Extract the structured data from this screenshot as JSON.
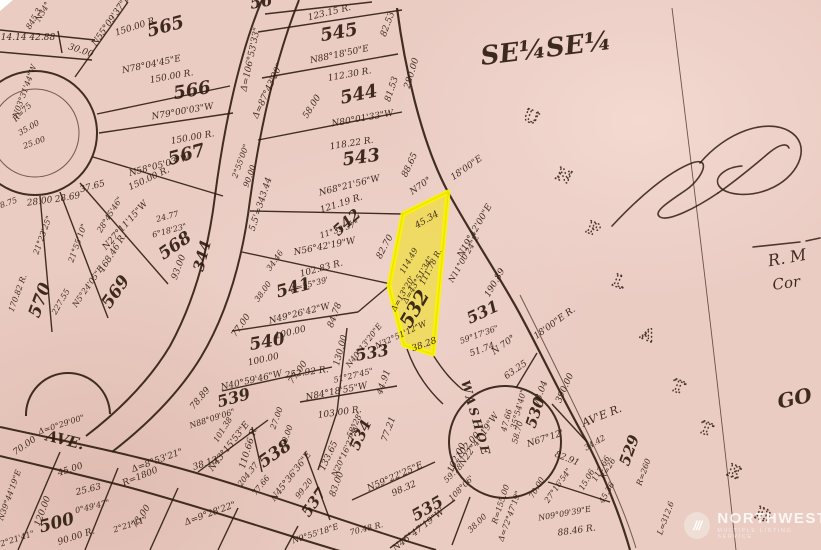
{
  "map": {
    "paper_color": "#eaccc3",
    "ink_color": "#2f1c10",
    "section_label": "SE¼SE¼",
    "highlight_lot": {
      "number": "532",
      "fill": "#f2e300",
      "stroke": "#fcf400"
    },
    "unplatted": {
      "letters": [
        "U",
        "N",
        "P",
        "L",
        "A",
        "T",
        "T",
        "E",
        "D"
      ],
      "positions": [
        [
          529,
          122
        ],
        [
          562,
          181
        ],
        [
          591,
          234
        ],
        [
          617,
          287
        ],
        [
          646,
          340
        ],
        [
          676,
          392
        ],
        [
          704,
          434
        ],
        [
          732,
          477
        ],
        [
          761,
          520
        ]
      ]
    },
    "labels": [
      {
        "t": "565",
        "x": 167,
        "y": 32,
        "r": -15,
        "s": 18,
        "b": 1
      },
      {
        "t": "566",
        "x": 193,
        "y": 96,
        "r": -10,
        "s": 18,
        "b": 1
      },
      {
        "t": "567",
        "x": 188,
        "y": 160,
        "r": -15,
        "s": 18,
        "b": 1
      },
      {
        "t": "568",
        "x": 178,
        "y": 250,
        "r": -35,
        "s": 17,
        "b": 1
      },
      {
        "t": "569",
        "x": 120,
        "y": 295,
        "r": -55,
        "s": 17,
        "b": 1
      },
      {
        "t": "570",
        "x": 45,
        "y": 302,
        "r": -70,
        "s": 17,
        "b": 1
      },
      {
        "t": "56",
        "x": 262,
        "y": 7,
        "r": -10,
        "s": 16,
        "b": 1
      },
      {
        "t": "545",
        "x": 340,
        "y": 38,
        "r": -10,
        "s": 18,
        "b": 1
      },
      {
        "t": "544",
        "x": 360,
        "y": 100,
        "r": -12,
        "s": 18,
        "b": 1
      },
      {
        "t": "543",
        "x": 362,
        "y": 163,
        "r": -8,
        "s": 18,
        "b": 1
      },
      {
        "t": "542",
        "x": 350,
        "y": 226,
        "r": -42,
        "s": 15,
        "b": 1
      },
      {
        "t": "541",
        "x": 295,
        "y": 293,
        "r": -15,
        "s": 17,
        "b": 1
      },
      {
        "t": "540",
        "x": 268,
        "y": 347,
        "r": -10,
        "s": 17,
        "b": 1
      },
      {
        "t": "539",
        "x": 235,
        "y": 403,
        "r": -15,
        "s": 16,
        "b": 1
      },
      {
        "t": "538",
        "x": 278,
        "y": 458,
        "r": -35,
        "s": 17,
        "b": 1
      },
      {
        "t": "537",
        "x": 318,
        "y": 505,
        "r": -55,
        "s": 15,
        "b": 1
      },
      {
        "t": "535",
        "x": 430,
        "y": 513,
        "r": -30,
        "s": 16,
        "b": 1
      },
      {
        "t": "534",
        "x": 365,
        "y": 437,
        "r": -65,
        "s": 15,
        "b": 1
      },
      {
        "t": "533",
        "x": 373,
        "y": 358,
        "r": -10,
        "s": 16,
        "b": 1
      },
      {
        "t": "532",
        "x": 420,
        "y": 312,
        "r": -60,
        "s": 19,
        "b": 1
      },
      {
        "t": "531",
        "x": 485,
        "y": 317,
        "r": -25,
        "s": 16,
        "b": 1
      },
      {
        "t": "530",
        "x": 540,
        "y": 414,
        "r": -72,
        "s": 15,
        "b": 1
      },
      {
        "t": "529",
        "x": 634,
        "y": 452,
        "r": -70,
        "s": 15,
        "b": 1
      },
      {
        "t": "500",
        "x": 58,
        "y": 528,
        "r": -15,
        "s": 17,
        "b": 1
      },
      {
        "t": "344",
        "x": 207,
        "y": 257,
        "r": -75,
        "s": 15,
        "b": 1
      },
      {
        "t": "WASHOE",
        "x": 472,
        "y": 420,
        "r": 74,
        "s": 12,
        "b": 1,
        "ls": 3
      },
      {
        "t": "AVE.",
        "x": 64,
        "y": 445,
        "r": 14,
        "s": 15,
        "b": 1
      },
      {
        "t": "AV'E R.",
        "x": 603,
        "y": 419,
        "r": -22,
        "s": 11
      },
      {
        "t": "SE¼SE¼",
        "x": 547,
        "y": 57,
        "r": -7,
        "s": 26,
        "b": 1
      },
      {
        "t": "GO",
        "x": 796,
        "y": 405,
        "r": -12,
        "s": 20,
        "b": 1
      },
      {
        "t": "R. M",
        "x": 788,
        "y": 263,
        "r": -10,
        "s": 16
      },
      {
        "t": "Cor",
        "x": 787,
        "y": 288,
        "r": -8,
        "s": 15
      },
      {
        "t": "14.14 42.88",
        "x": 28,
        "y": 40,
        "r": 0
      },
      {
        "t": "30.00",
        "x": 80,
        "y": 53,
        "r": 18
      },
      {
        "t": "N55°09'37\"E",
        "x": 113,
        "y": 22,
        "r": -55
      },
      {
        "t": "150.00 R.",
        "x": 137,
        "y": 29,
        "r": -18
      },
      {
        "t": "N78°04'45\"E",
        "x": 152,
        "y": 67,
        "r": -12
      },
      {
        "t": "150.00 R.",
        "x": 172,
        "y": 79,
        "r": -10
      },
      {
        "t": "N79°00'03\"W",
        "x": 183,
        "y": 114,
        "r": -10
      },
      {
        "t": "150.00 R.",
        "x": 193,
        "y": 140,
        "r": -10
      },
      {
        "t": "N58°05'03\"W",
        "x": 160,
        "y": 168,
        "r": -15
      },
      {
        "t": "N34°",
        "x": 45,
        "y": 13,
        "r": -60,
        "s": 8
      },
      {
        "t": "845.3",
        "x": 36,
        "y": 20,
        "r": -60,
        "s": 8
      },
      {
        "t": "2°55'00\"",
        "x": 243,
        "y": 162,
        "r": -70,
        "s": 8
      },
      {
        "t": "90.00",
        "x": 252,
        "y": 177,
        "r": -70,
        "s": 8
      },
      {
        "t": "Δ=87°43'20\"",
        "x": 270,
        "y": 92,
        "r": -65
      },
      {
        "t": "Δ=106°53'33\"",
        "x": 253,
        "y": 60,
        "r": -78
      },
      {
        "t": "5.5'=343.44",
        "x": 263,
        "y": 205,
        "r": -72
      },
      {
        "t": "123.15 R.",
        "x": 330,
        "y": 15,
        "r": -14
      },
      {
        "t": "82.53",
        "x": 390,
        "y": 25,
        "r": -70
      },
      {
        "t": "N88°18'50\"E",
        "x": 340,
        "y": 57,
        "r": -12
      },
      {
        "t": "112.30 R.",
        "x": 350,
        "y": 77,
        "r": -10
      },
      {
        "t": "81.53",
        "x": 394,
        "y": 90,
        "r": -72
      },
      {
        "t": "58.00",
        "x": 314,
        "y": 108,
        "r": -58
      },
      {
        "t": "280.00",
        "x": 414,
        "y": 74,
        "r": -73
      },
      {
        "t": "N80°01'33\"W",
        "x": 363,
        "y": 121,
        "r": -10
      },
      {
        "t": "118.22 R.",
        "x": 352,
        "y": 146,
        "r": -9
      },
      {
        "t": "88.65",
        "x": 412,
        "y": 166,
        "r": -65
      },
      {
        "t": "N68°21'56\"W",
        "x": 350,
        "y": 188,
        "r": -14
      },
      {
        "t": "N70°",
        "x": 422,
        "y": 188,
        "r": -35
      },
      {
        "t": "18'00\"E",
        "x": 468,
        "y": 170,
        "r": -35
      },
      {
        "t": "121.19 R.",
        "x": 342,
        "y": 206,
        "r": -18
      },
      {
        "t": "11°39'37\"",
        "x": 340,
        "y": 232,
        "r": -18,
        "s": 8
      },
      {
        "t": "82.70",
        "x": 387,
        "y": 248,
        "r": -62
      },
      {
        "t": "N56°42'19\"W",
        "x": 325,
        "y": 249,
        "r": -11
      },
      {
        "t": "102.83 R.",
        "x": 322,
        "y": 271,
        "r": -15
      },
      {
        "t": "Δ=55°39'",
        "x": 310,
        "y": 287,
        "r": -15,
        "s": 8
      },
      {
        "t": "34.46",
        "x": 277,
        "y": 262,
        "r": -55,
        "s": 8
      },
      {
        "t": "38.00",
        "x": 265,
        "y": 293,
        "r": -55,
        "s": 8
      },
      {
        "t": "84.78",
        "x": 337,
        "y": 316,
        "r": -70
      },
      {
        "t": "N49°26'42\"W",
        "x": 300,
        "y": 316,
        "r": -14
      },
      {
        "t": "100.00",
        "x": 291,
        "y": 335,
        "r": -14
      },
      {
        "t": "77.00",
        "x": 243,
        "y": 327,
        "r": -55
      },
      {
        "t": "100.00",
        "x": 264,
        "y": 362,
        "r": -13
      },
      {
        "t": "N40°59'46\"W",
        "x": 252,
        "y": 383,
        "r": -13
      },
      {
        "t": "77.00",
        "x": 300,
        "y": 374,
        "r": -55
      },
      {
        "t": "130.00",
        "x": 343,
        "y": 351,
        "r": -75
      },
      {
        "t": "N40°13'20\"E",
        "x": 366,
        "y": 347,
        "r": -52,
        "s": 8
      },
      {
        "t": "252.92 R.",
        "x": 307,
        "y": 375,
        "r": -8
      },
      {
        "t": "51°27'45\"",
        "x": 354,
        "y": 378,
        "r": -14,
        "s": 8
      },
      {
        "t": "N84°18'55\"W",
        "x": 337,
        "y": 394,
        "r": -11
      },
      {
        "t": "44.91",
        "x": 386,
        "y": 383,
        "r": -70
      },
      {
        "t": "103.00 R.",
        "x": 340,
        "y": 415,
        "r": -8
      },
      {
        "t": "45.34",
        "x": 428,
        "y": 222,
        "r": -30
      },
      {
        "t": "111.78 R.",
        "x": 433,
        "y": 268,
        "r": -63,
        "s": 8
      },
      {
        "t": "114.49",
        "x": 411,
        "y": 262,
        "r": -60,
        "s": 8
      },
      {
        "t": "Δ=43°51'34\"",
        "x": 420,
        "y": 281,
        "r": -60,
        "s": 8
      },
      {
        "t": "Δ=13°20'",
        "x": 405,
        "y": 295,
        "r": -60,
        "s": 8
      },
      {
        "t": "N32°51'12\"W",
        "x": 402,
        "y": 337,
        "r": -25,
        "s": 8
      },
      {
        "t": "38.28",
        "x": 425,
        "y": 347,
        "r": -20
      },
      {
        "t": "N19°42'00\"E",
        "x": 477,
        "y": 232,
        "r": -60
      },
      {
        "t": "N11°00'24\"E",
        "x": 466,
        "y": 260,
        "r": -60,
        "s": 8
      },
      {
        "t": "190.89",
        "x": 497,
        "y": 284,
        "r": -60
      },
      {
        "t": "59°17'36\"",
        "x": 480,
        "y": 337,
        "r": -20,
        "s": 8
      },
      {
        "t": "51.74",
        "x": 483,
        "y": 352,
        "r": -20
      },
      {
        "t": "N 70°",
        "x": 505,
        "y": 347,
        "r": -36
      },
      {
        "t": "18'00\"E R.",
        "x": 556,
        "y": 325,
        "r": -36
      },
      {
        "t": "63.25",
        "x": 517,
        "y": 372,
        "r": -35
      },
      {
        "t": "390.00",
        "x": 567,
        "y": 389,
        "r": -66
      },
      {
        "t": "78.04",
        "x": 543,
        "y": 394,
        "r": -70
      },
      {
        "t": "35°54'40\"",
        "x": 521,
        "y": 410,
        "r": -75,
        "s": 8
      },
      {
        "t": "47.66",
        "x": 509,
        "y": 421,
        "r": -75,
        "s": 8
      },
      {
        "t": "58.70",
        "x": 520,
        "y": 433,
        "r": -75,
        "s": 8
      },
      {
        "t": "N67°12'",
        "x": 546,
        "y": 441,
        "r": -18
      },
      {
        "t": "82.91",
        "x": 566,
        "y": 461,
        "r": 22
      },
      {
        "t": "70.00",
        "x": 539,
        "y": 489,
        "r": -60,
        "s": 8
      },
      {
        "t": "27°16'54\"",
        "x": 560,
        "y": 487,
        "r": -55,
        "s": 8
      },
      {
        "t": "N22°47'19\"W",
        "x": 481,
        "y": 441,
        "r": -55
      },
      {
        "t": "102.00",
        "x": 459,
        "y": 459,
        "r": -65
      },
      {
        "t": "R=155.00",
        "x": 503,
        "y": 505,
        "r": -72,
        "s": 8
      },
      {
        "t": "Δ=72°47'19\"",
        "x": 512,
        "y": 517,
        "r": -70,
        "s": 8
      },
      {
        "t": "34.42",
        "x": 596,
        "y": 445,
        "r": -30,
        "s": 8
      },
      {
        "t": "15.06",
        "x": 589,
        "y": 481,
        "r": -60,
        "s": 8
      },
      {
        "t": "R=26",
        "x": 610,
        "y": 470,
        "r": -60,
        "s": 8
      },
      {
        "t": "N09°09'39\"E",
        "x": 565,
        "y": 516,
        "r": -10,
        "s": 8
      },
      {
        "t": "88.46 R.",
        "x": 577,
        "y": 533,
        "r": -8
      },
      {
        "t": "R=260",
        "x": 646,
        "y": 473,
        "r": -70,
        "s": 8
      },
      {
        "t": "L=312.6",
        "x": 668,
        "y": 519,
        "r": -70,
        "s": 8
      },
      {
        "t": "112.66",
        "x": 603,
        "y": 470,
        "r": -60,
        "s": 8
      },
      {
        "t": "45.36",
        "x": 609,
        "y": 494,
        "r": -60,
        "s": 8
      },
      {
        "t": "N59°22'25\"E",
        "x": 396,
        "y": 479,
        "r": -24
      },
      {
        "t": "98.32",
        "x": 405,
        "y": 491,
        "r": -24
      },
      {
        "t": "N46°47'19\"W",
        "x": 420,
        "y": 532,
        "r": -38
      },
      {
        "t": "102.00",
        "x": 470,
        "y": 447,
        "r": -50
      },
      {
        "t": "59.78",
        "x": 455,
        "y": 475,
        "r": -45,
        "s": 8
      },
      {
        "t": "108°06'",
        "x": 463,
        "y": 490,
        "r": -45,
        "s": 8
      },
      {
        "t": "38.00",
        "x": 479,
        "y": 525,
        "r": -45,
        "s": 8
      },
      {
        "t": "58°28'",
        "x": 357,
        "y": 426,
        "r": -65,
        "s": 8
      },
      {
        "t": "N20°16'27\"W",
        "x": 348,
        "y": 452,
        "r": -65,
        "s": 8
      },
      {
        "t": "133.65",
        "x": 331,
        "y": 457,
        "r": -65
      },
      {
        "t": "77.21",
        "x": 391,
        "y": 430,
        "r": -70
      },
      {
        "t": "78.89",
        "x": 202,
        "y": 400,
        "r": -50
      },
      {
        "t": "N88°09'06\"",
        "x": 213,
        "y": 421,
        "r": -18,
        "s": 8
      },
      {
        "t": "101.38",
        "x": 225,
        "y": 431,
        "r": -58,
        "s": 8
      },
      {
        "t": "N43°15'53\"E",
        "x": 231,
        "y": 448,
        "r": -52
      },
      {
        "t": "38.13",
        "x": 206,
        "y": 466,
        "r": -18
      },
      {
        "t": "110.66 R.",
        "x": 251,
        "y": 448,
        "r": -73
      },
      {
        "t": "27.00",
        "x": 279,
        "y": 419,
        "r": -70,
        "s": 8
      },
      {
        "t": "50.00",
        "x": 289,
        "y": 437,
        "r": -70,
        "s": 8
      },
      {
        "t": "N45°36'36\"E",
        "x": 293,
        "y": 478,
        "r": -52
      },
      {
        "t": "99.20",
        "x": 306,
        "y": 490,
        "r": -52,
        "s": 8
      },
      {
        "t": "77.66",
        "x": 263,
        "y": 487,
        "r": -52,
        "s": 8
      },
      {
        "t": "204.37",
        "x": 250,
        "y": 476,
        "r": -52,
        "s": 8
      },
      {
        "t": "Δ=8°53'21\"",
        "x": 158,
        "y": 463,
        "r": -20
      },
      {
        "t": "R=1800",
        "x": 141,
        "y": 479,
        "r": -22
      },
      {
        "t": "Δ=9°28'22\"",
        "x": 211,
        "y": 516,
        "r": -20
      },
      {
        "t": "73.00",
        "x": 143,
        "y": 518,
        "r": -55
      },
      {
        "t": "2°21'41\"",
        "x": 131,
        "y": 527,
        "r": -18,
        "s": 8
      },
      {
        "t": "2°21'41\"",
        "x": 18,
        "y": 541,
        "r": -18,
        "s": 8
      },
      {
        "t": "70.00",
        "x": 26,
        "y": 448,
        "r": -35
      },
      {
        "t": "Δ=0°29'00\"",
        "x": 62,
        "y": 427,
        "r": -18,
        "s": 8
      },
      {
        "t": "45.00",
        "x": 71,
        "y": 472,
        "r": -18
      },
      {
        "t": "25.63",
        "x": 89,
        "y": 492,
        "r": -14
      },
      {
        "t": "0°49'47\"",
        "x": 93,
        "y": 509,
        "r": -14,
        "s": 8
      },
      {
        "t": "120.00",
        "x": 45,
        "y": 512,
        "r": -70
      },
      {
        "t": "N39°44'19\"E",
        "x": 12,
        "y": 496,
        "r": -70,
        "s": 8
      },
      {
        "t": "90.00 R.",
        "x": 77,
        "y": 539,
        "r": -18
      },
      {
        "t": "N9°55'18\"E",
        "x": 316,
        "y": 536,
        "r": -18,
        "s": 8
      },
      {
        "t": "83.00",
        "x": 339,
        "y": 485,
        "r": -70
      },
      {
        "t": "70.48 R.",
        "x": 367,
        "y": 531,
        "r": -14,
        "s": 8
      },
      {
        "t": "25.00",
        "x": 35,
        "y": 145,
        "r": -20,
        "s": 8
      },
      {
        "t": "35.00",
        "x": 30,
        "y": 130,
        "r": -30,
        "s": 8
      },
      {
        "t": "R=75",
        "x": 24,
        "y": 114,
        "r": -45,
        "s": 8
      },
      {
        "t": "N03°31'44\"W",
        "x": 27,
        "y": 92,
        "r": -70,
        "s": 8
      },
      {
        "t": "28.75",
        "x": 7,
        "y": 206,
        "r": -20,
        "s": 8
      },
      {
        "t": "28.00",
        "x": 40,
        "y": 204,
        "r": -8
      },
      {
        "t": "28.69",
        "x": 68,
        "y": 200,
        "r": -10
      },
      {
        "t": "37.65",
        "x": 93,
        "y": 189,
        "r": -15
      },
      {
        "t": "21°23'25\"",
        "x": 45,
        "y": 236,
        "r": -70,
        "s": 8
      },
      {
        "t": "21°55'10\"",
        "x": 80,
        "y": 244,
        "r": -70,
        "s": 8
      },
      {
        "t": "28°45'46\"",
        "x": 112,
        "y": 216,
        "r": -58,
        "s": 8
      },
      {
        "t": "N27°11'15\"W",
        "x": 127,
        "y": 227,
        "r": -48
      },
      {
        "t": "168.46 R.",
        "x": 115,
        "y": 254,
        "r": -58
      },
      {
        "t": "N5°24'05\"E",
        "x": 90,
        "y": 288,
        "r": -55,
        "s": 8
      },
      {
        "t": "227.55",
        "x": 63,
        "y": 303,
        "r": -60,
        "s": 8
      },
      {
        "t": "170.82 R.",
        "x": 20,
        "y": 294,
        "r": -70,
        "s": 8
      },
      {
        "t": "150.00 R.",
        "x": 150,
        "y": 181,
        "r": -25
      },
      {
        "t": "24.77",
        "x": 168,
        "y": 219,
        "r": -15,
        "s": 8
      },
      {
        "t": "6°18'23\"",
        "x": 170,
        "y": 233,
        "r": -15,
        "s": 8
      },
      {
        "t": "93.00",
        "x": 181,
        "y": 268,
        "r": -70
      }
    ]
  },
  "watermark": {
    "brand": "NORTHWEST",
    "tagline": "MULTIPLE LISTING SERVICE",
    "slashes": "///"
  }
}
